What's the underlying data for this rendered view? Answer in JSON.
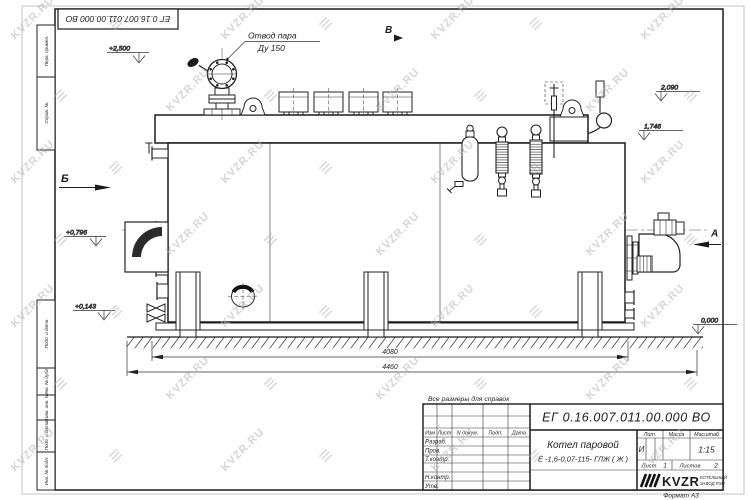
{
  "colors": {
    "ink": "#222222",
    "watermark": "#b5b5b5"
  },
  "watermark": {
    "text": "KVZR.RU"
  },
  "sheet": {
    "stamp_doc_number": "ЕГ 0.16.007.011.00.000 ВО",
    "format_note": "Формат А3",
    "margin_fields": {
      "perv_primen": "Перв. примен.",
      "sprav_no": "Справ. №",
      "podp_data_1": "Подп. и дата",
      "inv_dubl": "Инв. № дубл.",
      "vzam_inv": "Взам. инв. №",
      "podp_data_2": "Подп. и дата",
      "inv_podl": "Инв. № подл."
    }
  },
  "drawing": {
    "callout_steam_line1": "Отвод пара",
    "callout_steam_line2": "Ду 150",
    "view_a": "А",
    "view_b": "Б",
    "view_v": "В",
    "elev_2500": "+2,500",
    "elev_2090": "2,090",
    "elev_1746": "1,746",
    "elev_0796": "+0,796",
    "elev_0143": "+0,143",
    "elev_0000": "0,000",
    "dim_4080": "4080",
    "dim_4460": "4460"
  },
  "note_reference": "Все размеры для справок",
  "title_block": {
    "doc_number": "ЕГ 0.16.007.011.00.000 ВО",
    "col_izm": "Изм",
    "col_list": "Лист",
    "col_ndoc": "N докум.",
    "col_podp": "Подп.",
    "col_data": "Дата",
    "row_razrab": "Разраб.",
    "row_prov": "Пров.",
    "row_tkontr": "Т.контр.",
    "row_nkontr": "Н.контр.",
    "row_utv": "Утв.",
    "product_line1": "Котел паровой",
    "product_line2": "Е -1,6-0,07-115- ГЛЖ ( Ж )",
    "lit_label": "Лит.",
    "mass_label": "Масса",
    "scale_label": "Масштаб",
    "lit_value": "И",
    "scale_value": "1:15",
    "sheet_label": "Лист",
    "sheet_value": "1",
    "sheets_label": "Листов",
    "sheets_value": "2",
    "brand": "KVZR",
    "brand_sub1": "КОТЕЛЬНЫЙ",
    "brand_sub2": "ЗАВОД РЭП"
  }
}
